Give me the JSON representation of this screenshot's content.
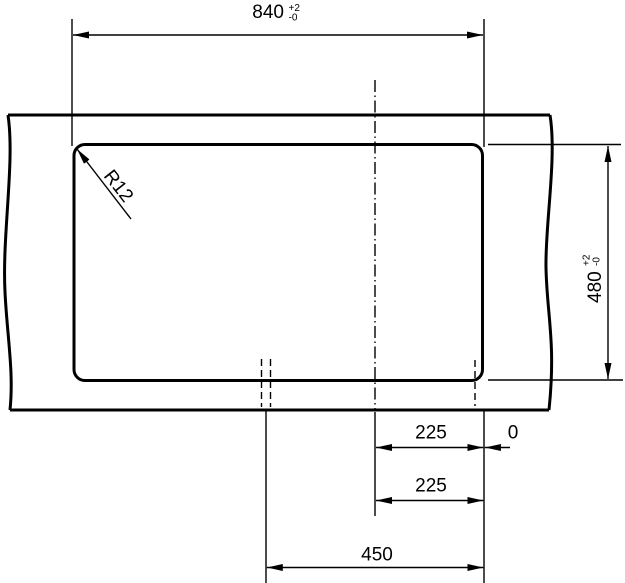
{
  "drawing": {
    "ink_color": "#000000",
    "background_color": "#ffffff",
    "labels": {
      "width_dim": {
        "value": "840",
        "tol_up": "+2",
        "tol_down": "-0"
      },
      "height_dim": {
        "value": "480",
        "tol_up": "+2",
        "tol_down": "-0"
      },
      "corner_radius": "R12",
      "offset_right": "225",
      "zero_reference": "0",
      "offset_center": "225",
      "span_total": "450"
    }
  }
}
